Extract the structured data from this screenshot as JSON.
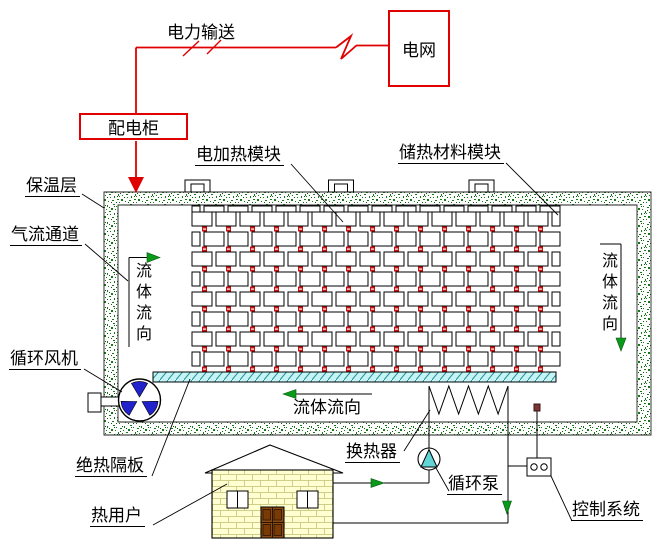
{
  "labels": {
    "power_grid": "电网",
    "power_transmission": "电力输送",
    "distribution_cabinet": "配电柜",
    "insulation_layer": "保温层",
    "air_flow_channel": "气流通道",
    "electric_heating_module": "电加热模块",
    "heat_storage_module": "储热材料模块",
    "circulation_fan": "循环风机",
    "adiabatic_partition": "绝热隔板",
    "heat_user": "热用户",
    "heat_exchanger": "换热器",
    "circulation_pump": "循环泵",
    "control_system": "控制系统",
    "fluid_flow": "流体流向"
  },
  "colors": {
    "line_red": "#e00000",
    "wall_green": "#157a15",
    "wall_green_dark": "#0a5a0a",
    "heater_red": "#c41111",
    "partition_cyan": "#c6f3f3",
    "partition_hatch": "#1f8f9f",
    "fan_blue": "#2222cc",
    "pump_cyan": "#62d6d6",
    "arrow_green": "#0a9a1a",
    "house_wall": "#ffffd2",
    "house_brick_line": "#cfcf8a",
    "door_brown": "#8a4a15",
    "door_panel": "#7a3a05",
    "sensor_maroon": "#7a3535"
  }
}
